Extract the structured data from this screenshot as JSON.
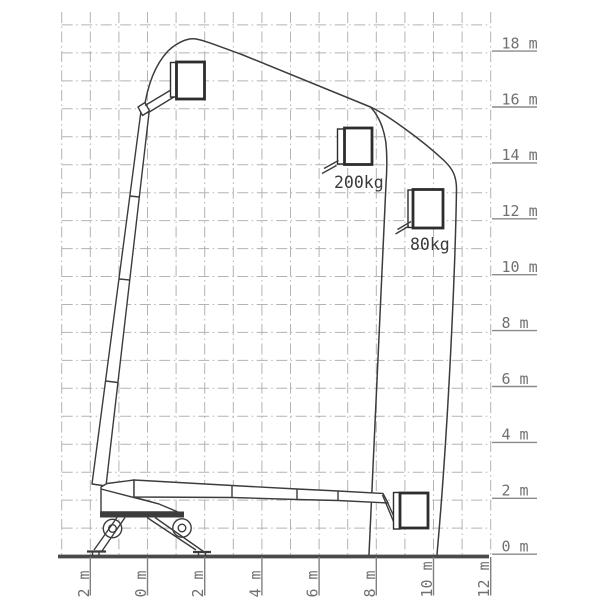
{
  "diagram": {
    "kind": "aerial-work-platform-working-envelope",
    "background": "#ffffff"
  },
  "y_axis": {
    "unit": "m",
    "labels": [
      "18 m",
      "16 m",
      "14 m",
      "12 m",
      "10 m",
      "8 m",
      "6 m",
      "4 m",
      "2 m",
      "0 m"
    ]
  },
  "x_axis": {
    "unit": "m",
    "labels": [
      "2 m",
      "0 m",
      "2 m",
      "4 m",
      "6 m",
      "8 m",
      "10 m",
      "12 m"
    ]
  },
  "capacities": {
    "inner_zone": "200kg",
    "outer_zone": "80kg"
  },
  "envelope_data": {
    "units": "m",
    "max_platform_height_m": 18.5,
    "outreach_at_200kg_m": 8.4,
    "outreach_at_80kg_m": 10.8,
    "outreach_at_ground_m": 10.1,
    "outer_boundary_points_m": [
      [
        -0.1,
        16.0
      ],
      [
        0.7,
        17.6
      ],
      [
        1.6,
        18.5
      ],
      [
        3.3,
        17.9
      ],
      [
        7.8,
        16.1
      ],
      [
        9.4,
        14.9
      ],
      [
        10.5,
        14.0
      ],
      [
        10.8,
        13.3
      ],
      [
        10.7,
        9.2
      ],
      [
        10.1,
        0.0
      ]
    ],
    "inner_boundary_points_m": [
      [
        7.8,
        16.1
      ],
      [
        8.3,
        14.8
      ],
      [
        8.4,
        13.5
      ],
      [
        7.7,
        0.0
      ]
    ],
    "platform_icon_positions_m": [
      {
        "outreach": 1.5,
        "height": 17.7,
        "label": ""
      },
      {
        "outreach": 7.4,
        "height": 15.3,
        "label": "200kg"
      },
      {
        "outreach": 9.8,
        "height": 13.1,
        "label": "80kg"
      },
      {
        "outreach": 9.3,
        "height": 2.3,
        "label": ""
      }
    ]
  },
  "colors": {
    "machine_line": "#3c3c3c",
    "basket_line": "#2d2d2d",
    "grid_line": "#b3b3b3",
    "axis_text": "#707070",
    "load_text": "#3a3a3a",
    "ground_line": "#4a4a4a",
    "background": "#ffffff"
  }
}
